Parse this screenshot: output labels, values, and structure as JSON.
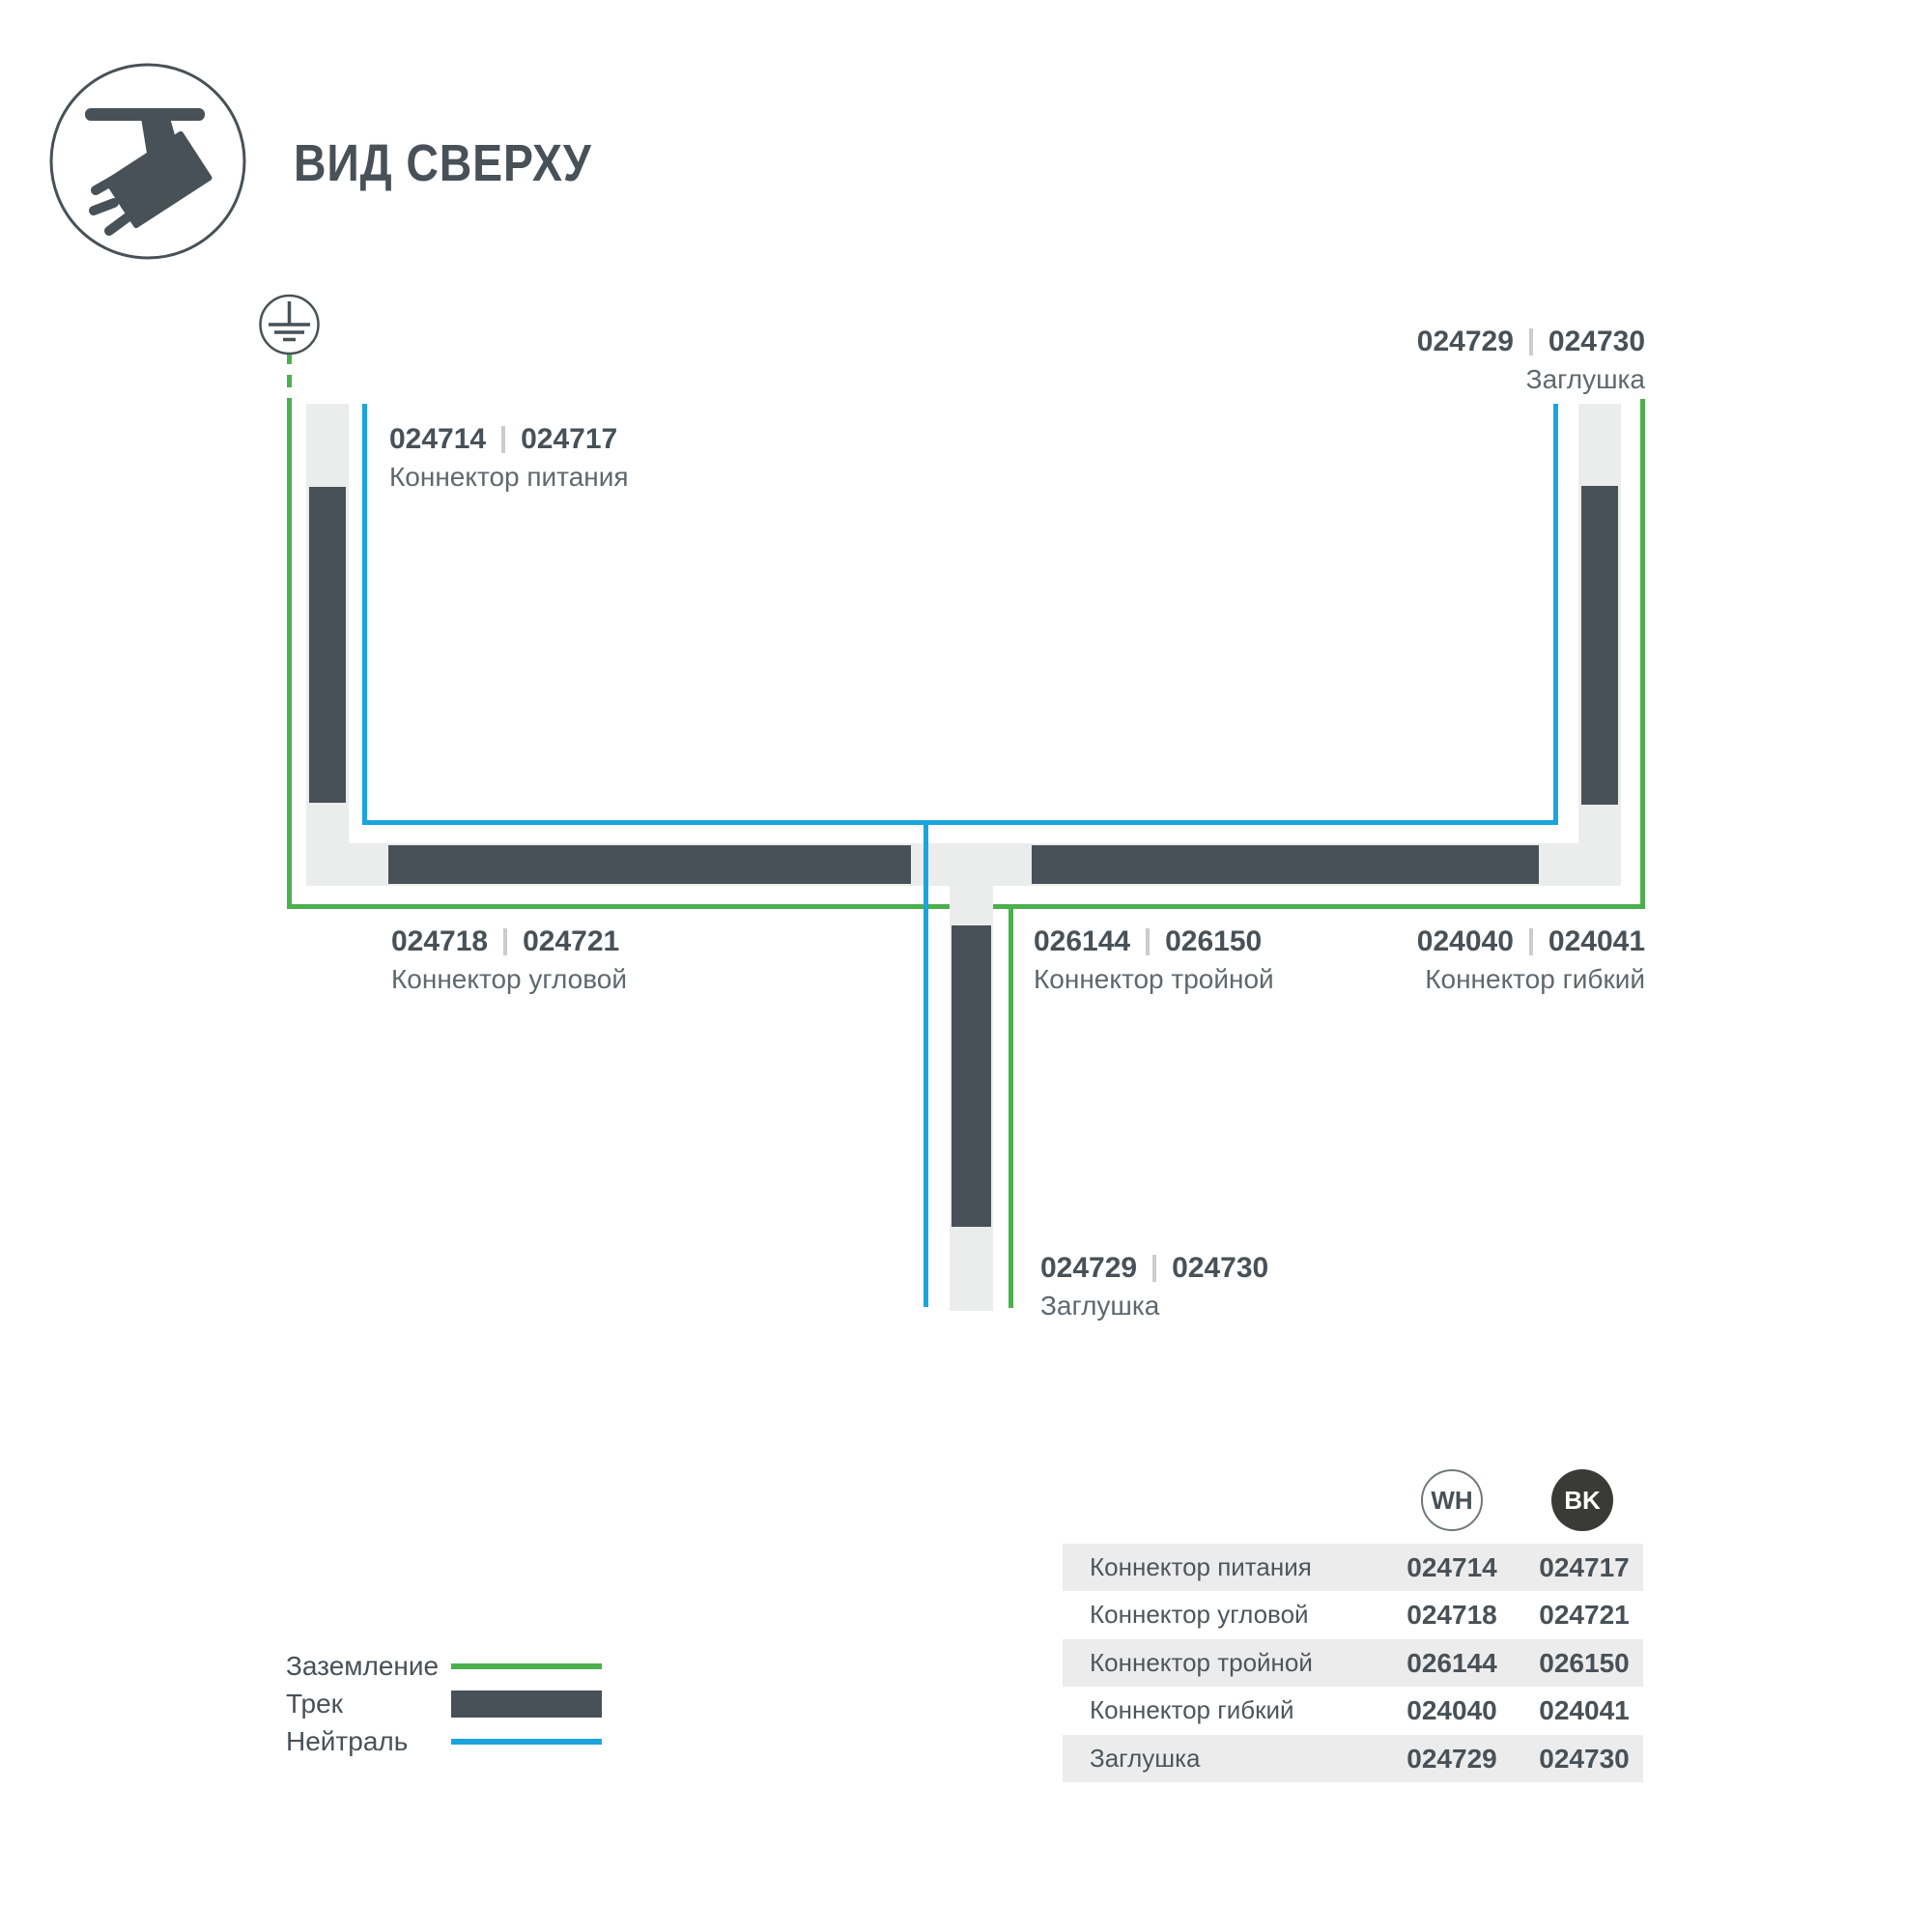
{
  "header": {
    "title": "ВИД СВЕРХУ"
  },
  "colors": {
    "dark": "#485157",
    "track_fill": "#ebedec",
    "green": "#4cb04f",
    "blue": "#1ca4de",
    "bk": "#3a3a37",
    "row_alt": "#ececec"
  },
  "diagram": {
    "labels": {
      "power": {
        "code_wh": "024714",
        "code_bk": "024717",
        "name": "Коннектор питания"
      },
      "cap_top": {
        "code_wh": "024729",
        "code_bk": "024730",
        "name": "Заглушка"
      },
      "corner": {
        "code_wh": "024718",
        "code_bk": "024721",
        "name": "Коннектор угловой"
      },
      "triple": {
        "code_wh": "026144",
        "code_bk": "026150",
        "name": "Коннектор тройной"
      },
      "flex": {
        "code_wh": "024040",
        "code_bk": "024041",
        "name": "Коннектор гибкий"
      },
      "cap_bottom": {
        "code_wh": "024729",
        "code_bk": "024730",
        "name": "Заглушка"
      }
    }
  },
  "legend": {
    "ground_label": "Заземление",
    "track_label": "Трек",
    "neutral_label": "Нейтраль"
  },
  "table": {
    "col_wh": "WH",
    "col_bk": "BK",
    "rows": [
      {
        "name": "Коннектор питания",
        "wh": "024714",
        "bk": "024717"
      },
      {
        "name": "Коннектор угловой",
        "wh": "024718",
        "bk": "024721"
      },
      {
        "name": "Коннектор тройной",
        "wh": "026144",
        "bk": "026150"
      },
      {
        "name": "Коннектор гибкий",
        "wh": "024040",
        "bk": "024041"
      },
      {
        "name": "Заглушка",
        "wh": "024729",
        "bk": "024730"
      }
    ]
  }
}
